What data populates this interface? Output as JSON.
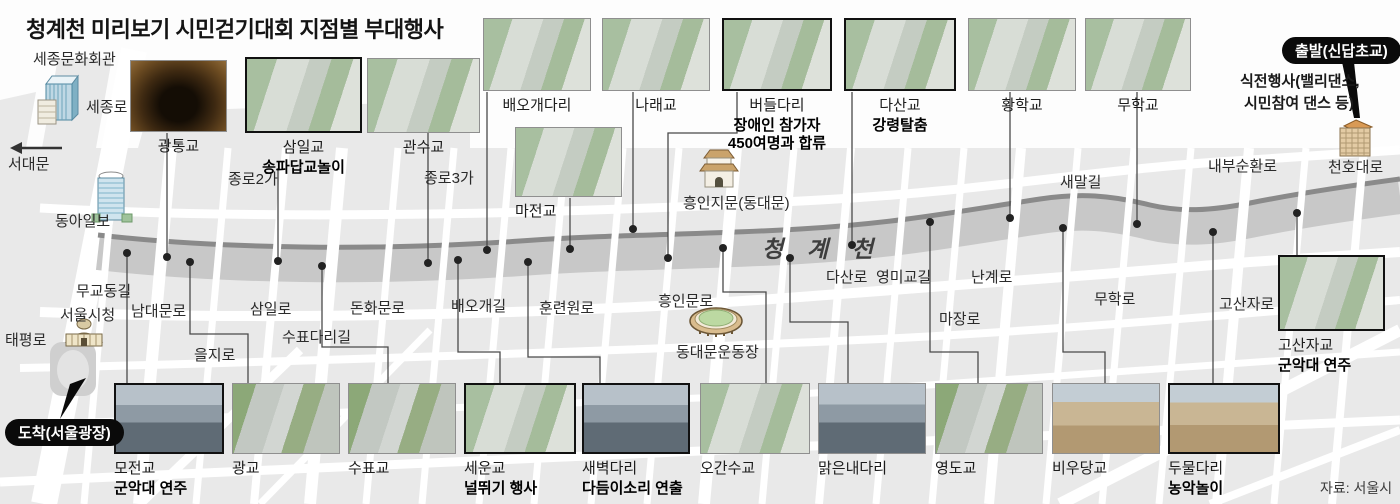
{
  "title": "청계천 미리보기 시민걷기대회 지점별 부대행사",
  "source": "자료: 서울시",
  "stream": {
    "name": "청 계 천"
  },
  "badges": {
    "start": "출발(신답초교)",
    "finish": "도착(서울광장)"
  },
  "start_event": {
    "line1": "식전행사(밸리댄스,",
    "line2": "시민참여 댄스 등)"
  },
  "landmarks": {
    "sejong_center": "세종문화회관",
    "sejongno": "세종로",
    "seodaemun": "서대문",
    "donga_ilbo": "동아일보",
    "city_hall": "서울시청",
    "taepyeongno": "태평로",
    "heunginjimun": "흥인지문(동대문)",
    "ddm_stadium": "동대문운동장",
    "cheonhodaero": "천호대로"
  },
  "roads": {
    "mugyodong": "무교동길",
    "namdaemunno": "남대문로",
    "euljiro": "을지로",
    "samilro": "삼일로",
    "supyodari": "수표다리길",
    "donhwamunno": "돈화문로",
    "jongno2ga": "종로2가",
    "jongno3ga": "종로3가",
    "baeogae": "배오개길",
    "hullyeonwonno": "훈련원로",
    "heunginmunno": "흥인문로",
    "dasanro": "다산로",
    "yeongmigyo": "영미교길",
    "nangyero": "난계로",
    "majangro": "마장로",
    "muhakro": "무학로",
    "saemalgil": "새말길",
    "naebusunhwanno": "내부순환로",
    "gosanjaro": "고산자로"
  },
  "bridges": {
    "gwangtong": {
      "name": "광통교"
    },
    "samil": {
      "name": "삼일교",
      "event": "송파답교놀이"
    },
    "gwansu": {
      "name": "관수교"
    },
    "baeogaedari": {
      "name": "배오개다리"
    },
    "narae": {
      "name": "나래교"
    },
    "beodeul": {
      "name": "버들다리",
      "event": "장애인 참가자 450여명과 합류"
    },
    "dasan": {
      "name": "다산교",
      "event": "강령탈춤"
    },
    "hwanghak": {
      "name": "황학교"
    },
    "muhak": {
      "name": "무학교"
    },
    "majeon": {
      "name": "마전교"
    },
    "gosanja": {
      "name": "고산자교",
      "event": "군악대 연주"
    },
    "mojeon": {
      "name": "모전교",
      "event": "군악대 연주"
    },
    "gwanggyo": {
      "name": "광교"
    },
    "supyo": {
      "name": "수표교"
    },
    "seun": {
      "name": "세운교",
      "event": "널뛰기 행사"
    },
    "saebyeok": {
      "name": "새벽다리",
      "event": "다듬이소리 연출"
    },
    "ogansu": {
      "name": "오간수교"
    },
    "malgeunnae": {
      "name": "맑은내다리"
    },
    "yeongdo": {
      "name": "영도교"
    },
    "biudang": {
      "name": "비우당교"
    },
    "dumul": {
      "name": "두물다리",
      "event": "농악놀이"
    }
  },
  "colors": {
    "stream": "#c8c8c8",
    "stream_edge": "#8a8a8a",
    "map_block": "#e9e9e9",
    "badge_bg": "#0a0a0a"
  }
}
